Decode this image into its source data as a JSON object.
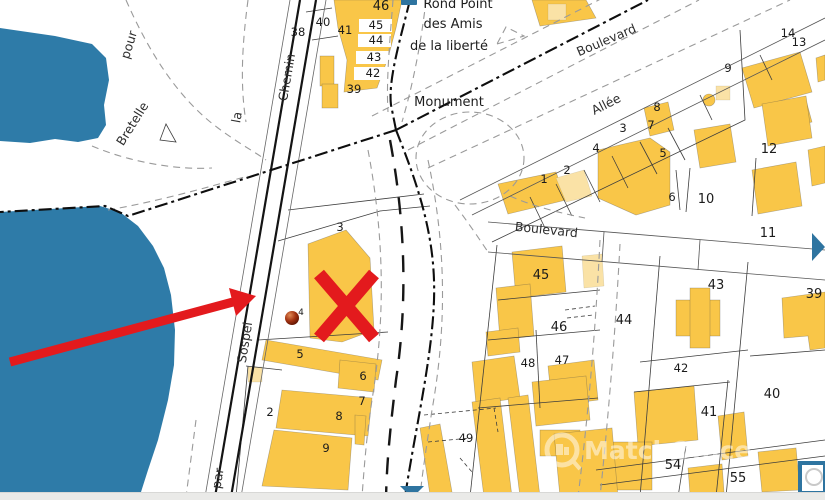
{
  "map": {
    "watermark": "MatchOffice",
    "attribution": "Données cadastrales : mise à jour DGFiP — 43.6947834 57 — 7.2487969 53",
    "poi": {
      "roundabout_line1": "Rond Point",
      "roundabout_line2": "des Amis",
      "roundabout_line3": "de la liberté",
      "monument": "Monument"
    },
    "streets": [
      {
        "label": "pour",
        "x": 133,
        "y": 46,
        "rot": -73,
        "s": 12.5
      },
      {
        "label": "Bretelle",
        "x": 136,
        "y": 126,
        "rot": -58,
        "s": 12.5
      },
      {
        "label": "la",
        "x": 241,
        "y": 118,
        "rot": -80,
        "s": 12
      },
      {
        "label": "Chemin",
        "x": 291,
        "y": 78,
        "rot": -80,
        "s": 12.5
      },
      {
        "label": "Sospel",
        "x": 249,
        "y": 343,
        "rot": -81,
        "s": 12
      },
      {
        "label": "par",
        "x": 222,
        "y": 479,
        "rot": -81,
        "s": 12
      },
      {
        "label": "Boulevard",
        "x": 608,
        "y": 44,
        "rot": -23,
        "s": 13.5
      },
      {
        "label": "Allée",
        "x": 608,
        "y": 108,
        "rot": -27,
        "s": 13
      },
      {
        "label": "Boulevard",
        "x": 546,
        "y": 234,
        "rot": 6,
        "s": 13.5
      }
    ],
    "parcels": [
      {
        "n": "38",
        "x": 298,
        "y": 36
      },
      {
        "n": "40",
        "x": 323,
        "y": 26
      },
      {
        "n": "41",
        "x": 345,
        "y": 34
      },
      {
        "n": "46",
        "x": 381,
        "y": 10,
        "big": true
      },
      {
        "n": "45",
        "x": 376,
        "y": 29
      },
      {
        "n": "44",
        "x": 376,
        "y": 44
      },
      {
        "n": "43",
        "x": 374,
        "y": 61
      },
      {
        "n": "42",
        "x": 373,
        "y": 77
      },
      {
        "n": "39",
        "x": 354,
        "y": 93
      },
      {
        "n": "3",
        "x": 340,
        "y": 231
      },
      {
        "n": "5",
        "x": 300,
        "y": 358
      },
      {
        "n": "6",
        "x": 363,
        "y": 380
      },
      {
        "n": "7",
        "x": 362,
        "y": 405
      },
      {
        "n": "8",
        "x": 339,
        "y": 420
      },
      {
        "n": "2",
        "x": 270,
        "y": 416
      },
      {
        "n": "9",
        "x": 326,
        "y": 452
      },
      {
        "n": "1",
        "x": 544,
        "y": 183
      },
      {
        "n": "2",
        "x": 567,
        "y": 174
      },
      {
        "n": "4",
        "x": 596,
        "y": 152
      },
      {
        "n": "3",
        "x": 623,
        "y": 132
      },
      {
        "n": "7",
        "x": 651,
        "y": 129
      },
      {
        "n": "5",
        "x": 663,
        "y": 157
      },
      {
        "n": "8",
        "x": 657,
        "y": 111
      },
      {
        "n": "9",
        "x": 728,
        "y": 72
      },
      {
        "n": "14",
        "x": 788,
        "y": 37
      },
      {
        "n": "13",
        "x": 799,
        "y": 46
      },
      {
        "n": "6",
        "x": 672,
        "y": 201
      },
      {
        "n": "10",
        "x": 706,
        "y": 203,
        "big": true
      },
      {
        "n": "12",
        "x": 769,
        "y": 153,
        "big": true
      },
      {
        "n": "11",
        "x": 768,
        "y": 237,
        "big": true
      },
      {
        "n": "45",
        "x": 541,
        "y": 279,
        "big": true
      },
      {
        "n": "46",
        "x": 559,
        "y": 331,
        "big": true
      },
      {
        "n": "48",
        "x": 528,
        "y": 367
      },
      {
        "n": "47",
        "x": 562,
        "y": 364
      },
      {
        "n": "44",
        "x": 624,
        "y": 324,
        "big": true
      },
      {
        "n": "43",
        "x": 716,
        "y": 289,
        "big": true
      },
      {
        "n": "39",
        "x": 814,
        "y": 298,
        "big": true
      },
      {
        "n": "42",
        "x": 681,
        "y": 372
      },
      {
        "n": "40",
        "x": 772,
        "y": 398,
        "big": true
      },
      {
        "n": "41",
        "x": 709,
        "y": 416,
        "big": true
      },
      {
        "n": "49",
        "x": 466,
        "y": 442
      },
      {
        "n": "54",
        "x": 673,
        "y": 469,
        "big": true
      },
      {
        "n": "55",
        "x": 738,
        "y": 482,
        "big": true
      },
      {
        "n": "4",
        "x": 301,
        "y": 315,
        "tiny": true
      }
    ],
    "colors": {
      "water": "#2e7ba8",
      "building": "#f9c648",
      "building_light": "#fae2a6",
      "red": "#e31a1d",
      "ui_blue": "#2e74a0",
      "line": "#3d3d3d",
      "bar": "#eaeae8"
    }
  }
}
